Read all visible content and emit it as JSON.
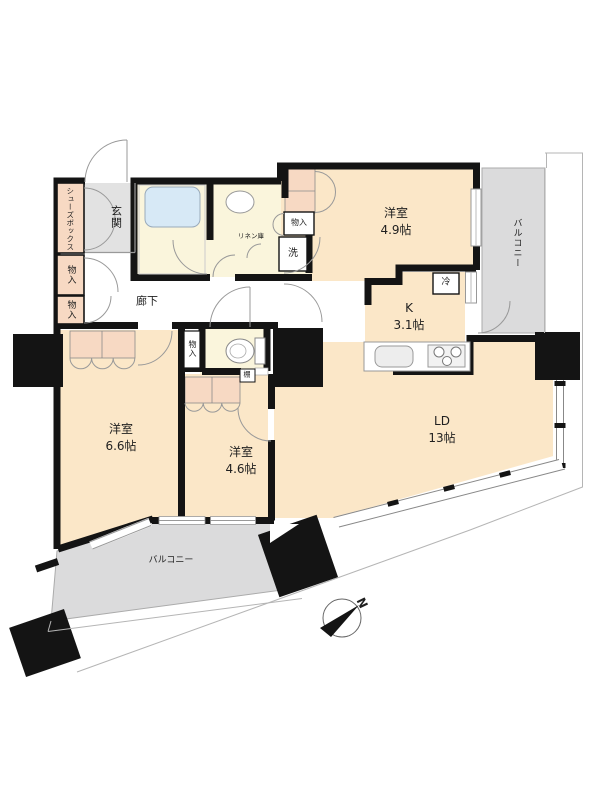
{
  "plan_title": "apartment-floor-plan",
  "rooms": {
    "r49": {
      "name": "洋室",
      "size": "4.9帖"
    },
    "r66": {
      "name": "洋室",
      "size": "6.6帖"
    },
    "r46": {
      "name": "洋室",
      "size": "4.6帖"
    },
    "ld": {
      "name": "LD",
      "size": "13帖"
    },
    "k": {
      "name": "K",
      "size": "3.1帖"
    }
  },
  "areas": {
    "genkan": "玄関",
    "rouka": "廊下",
    "balcony_right": "バルコニー",
    "balcony_bottom": "バルコニー"
  },
  "fixtures": {
    "shoes_box": "シューズボックス",
    "storage": "物入",
    "linen": "リネン庫",
    "washer": "洗",
    "fridge": "冷",
    "shelf": "棚"
  },
  "compass": {
    "north": "N"
  },
  "palette": {
    "room_beige": "#fbe7c8",
    "closet_pink": "#f7d9c3",
    "wet_yellow": "#faf5dc",
    "bathtub_blue": "#d7e9f6",
    "balcony_gray": "#dbdbdc",
    "genkan_gray": "#e2e2e2",
    "wall_black": "#141414"
  }
}
